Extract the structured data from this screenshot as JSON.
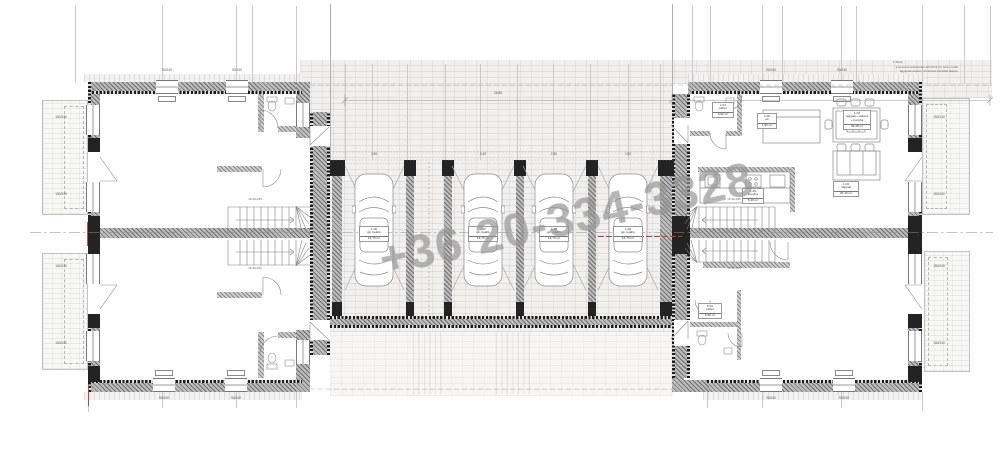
{
  "watermark": {
    "text": "+36 20-334-3328"
  },
  "annotation": {
    "ref": "1 SIGA",
    "line1": "a tervezett térburkolat 10×20×6 cm beton térkő",
    "line2": "ágyazóhomokon, tömörített zúzottkő alapon"
  },
  "dimensions": {
    "total_width": "26,85",
    "bay_width": "2,50",
    "window_top": "90/240",
    "window_side": "150/240",
    "stair_note": "13×18,4/25"
  },
  "garage": {
    "bays": [
      {
        "no": "1.06",
        "name": "gk. beálló",
        "area": "16,73 m²"
      },
      {
        "no": "1.07",
        "name": "gk. beálló",
        "area": "16,73 m²"
      },
      {
        "no": "1.08",
        "name": "gk. beálló",
        "area": "16,73 m²"
      },
      {
        "no": "1.09",
        "name": "gk. beálló",
        "area": "16,73 m²"
      }
    ]
  },
  "rooms": {
    "hall": {
      "no": "1.01",
      "name": "előtér",
      "area": "3,92 m²"
    },
    "wc": {
      "no": "1.02",
      "name": "wc",
      "area": "1,50 m²"
    },
    "living": {
      "no": "1.03",
      "name": "nappali + étkező",
      "name2": "+ konyha",
      "area": "34,40 m²"
    },
    "nappali": {
      "no": "1.04",
      "name": "nappali",
      "area": "20,10 m²"
    },
    "kitchen": {
      "no": "1.05",
      "name": "konyha",
      "area": "8,40 m²"
    },
    "hall2": {
      "no": "0.01",
      "name": "előtér",
      "area": "3,90 m²"
    }
  },
  "colors": {
    "wall": "#6f6f6f",
    "insulation": "#1c1c1c",
    "paving_line": "#b9b7b4",
    "watermark": "#9e9e9e",
    "section_red": "#c23b3b"
  }
}
